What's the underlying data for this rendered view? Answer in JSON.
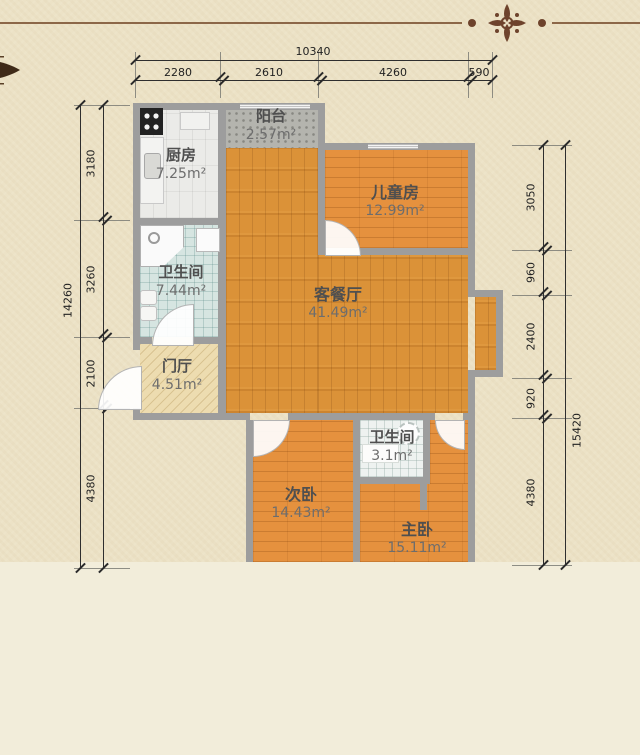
{
  "palette": {
    "background": "#ece2c6",
    "background_lower": "#f2edda",
    "wall": "#9d9d9d",
    "wood_living": "#db9238",
    "wood_bedroom": "#e5913e",
    "ornament_brown": "#6e432c",
    "dimension_text": "#222222"
  },
  "dimensions": {
    "top": {
      "total": "10340",
      "segments": [
        "2280",
        "2610",
        "4260",
        "590"
      ]
    },
    "left": {
      "total": "14260",
      "segments": [
        "3180",
        "3260",
        "2100",
        "4380"
      ]
    },
    "right": {
      "total": "15420",
      "segments": [
        "3050",
        "960",
        "2400",
        "920",
        "4380"
      ]
    }
  },
  "rooms": {
    "balcony": {
      "name": "阳台",
      "area": "2.57m²"
    },
    "kitchen": {
      "name": "厨房",
      "area": "7.25m²"
    },
    "kids": {
      "name": "儿童房",
      "area": "12.99m²"
    },
    "bath_main": {
      "name": "卫生间",
      "area": "7.44m²"
    },
    "living": {
      "name": "客餐厅",
      "area": "41.49m²"
    },
    "foyer": {
      "name": "门厅",
      "area": "4.51m²"
    },
    "bed_second": {
      "name": "次卧",
      "area": "14.43m²"
    },
    "bath_small": {
      "name": "卫生间",
      "area": "3.1m²"
    },
    "bed_master": {
      "name": "主卧",
      "area": "15.11m²"
    }
  }
}
